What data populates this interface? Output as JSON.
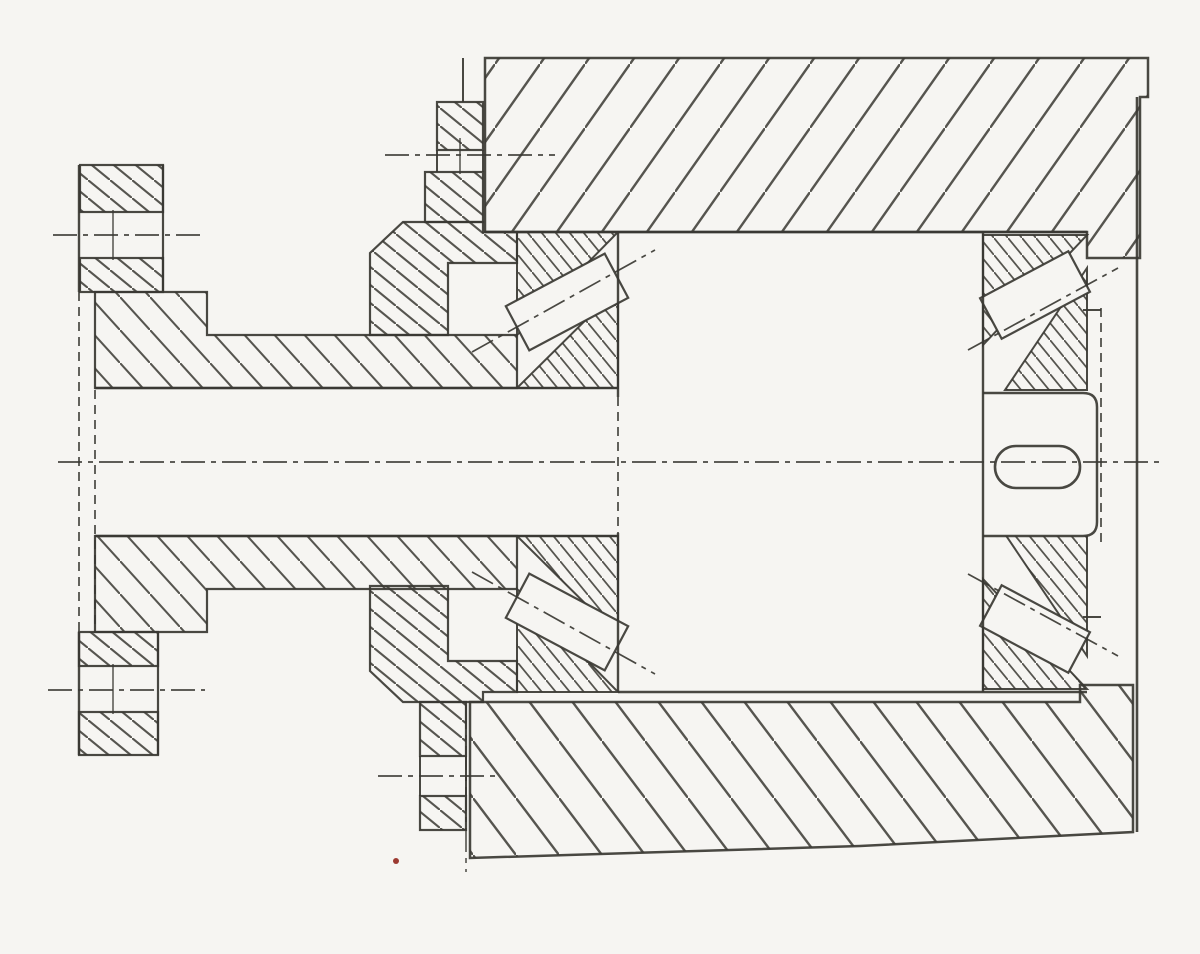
{
  "document": {
    "kind": "scanned-engineering-section-drawing",
    "colors": {
      "paper": "#f6f5f2",
      "ink": "#3a3833",
      "artifact_red": "#9c3a31"
    }
  },
  "canvas": {
    "width": 1200,
    "height": 954
  },
  "dashes": {
    "cl": "24 6 5 6",
    "hid": "9 6"
  },
  "hatches": [
    {
      "id": "hatch-housing-top",
      "dir": "/",
      "tw": 45,
      "th": 64,
      "sw": 2.4
    },
    {
      "id": "hatch-housing-bottom",
      "dir": "\\",
      "tw": 43,
      "th": 57,
      "sw": 2.4
    },
    {
      "id": "hatch-main",
      "dir": "\\",
      "tw": 22,
      "th": 18,
      "sw": 2.1
    },
    {
      "id": "hatch-sparse",
      "dir": "\\",
      "tw": 30,
      "th": 33,
      "sw": 2.1
    },
    {
      "id": "hatch-dense",
      "dir": "\\",
      "tw": 14,
      "th": 17,
      "sw": 1.8
    }
  ],
  "shapes": [
    {
      "name": "housing-upper-block",
      "type": "poly",
      "pts": "485,58 1148,58 1148,97 1140,97 1140,258 1087,258 1087,232 485,232",
      "fill": "hatch-housing-top",
      "sw": 2.5
    },
    {
      "name": "housing-lower-block",
      "type": "poly",
      "pts": "470,702 1080,702 1080,685 1133,685 1133,832 860,846 470,858",
      "fill": "hatch-housing-bottom",
      "sw": 2.5
    },
    {
      "name": "top-cap-lug",
      "type": "rect",
      "x": 437,
      "y": 102,
      "w": 46,
      "h": 48,
      "fill": "hatch-main",
      "sw": 2.2
    },
    {
      "name": "top-cap-neck",
      "type": "rect",
      "x": 425,
      "y": 172,
      "w": 58,
      "h": 50,
      "fill": "hatch-main",
      "sw": 2.2
    },
    {
      "name": "top-cap-body",
      "type": "poly",
      "pts": "370,253 403,222 483,222 483,232 517,232 517,263 448,263 448,335 370,335",
      "fill": "hatch-main",
      "sw": 2.2
    },
    {
      "name": "bottom-cap-body",
      "type": "poly",
      "pts": "370,671 403,702 483,702 483,692 517,692 517,661 448,661 448,586 370,586",
      "fill": "hatch-main",
      "sw": 2.2
    },
    {
      "name": "bottom-cap-neck",
      "type": "rect",
      "x": 420,
      "y": 702,
      "w": 46,
      "h": 54,
      "fill": "hatch-main",
      "sw": 2.2
    },
    {
      "name": "bottom-cap-lug",
      "type": "rect",
      "x": 420,
      "y": 796,
      "w": 46,
      "h": 34,
      "fill": "hatch-main",
      "sw": 2.2
    },
    {
      "name": "flange-top-outer",
      "type": "rect",
      "x": 80,
      "y": 165,
      "w": 83,
      "h": 47,
      "fill": "hatch-main",
      "sw": 2.2
    },
    {
      "name": "flange-top-inner",
      "type": "rect",
      "x": 80,
      "y": 258,
      "w": 83,
      "h": 34,
      "fill": "hatch-main",
      "sw": 2.2
    },
    {
      "name": "flange-bottom-inner",
      "type": "rect",
      "x": 79,
      "y": 632,
      "w": 79,
      "h": 34,
      "fill": "hatch-main",
      "sw": 2.2
    },
    {
      "name": "flange-bottom-outer",
      "type": "rect",
      "x": 79,
      "y": 712,
      "w": 79,
      "h": 43,
      "fill": "hatch-main",
      "sw": 2.2
    },
    {
      "name": "hub-sleeve-top",
      "type": "poly",
      "pts": "95,292 207,292 207,335 517,335 517,388 95,388",
      "fill": "hatch-sparse",
      "sw": 2.2
    },
    {
      "name": "hub-sleeve-bottom",
      "type": "poly",
      "pts": "95,536 517,536 517,589 207,589 207,632 95,632",
      "fill": "hatch-sparse",
      "sw": 2.2
    },
    {
      "name": "bearing-top-left-cup",
      "type": "poly",
      "pts": "517,232 618,232 517,335",
      "fill": "hatch-dense",
      "sw": 2
    },
    {
      "name": "bearing-top-left-cone",
      "type": "poly",
      "pts": "517,388 618,388 618,288",
      "fill": "hatch-dense",
      "sw": 2
    },
    {
      "name": "bearing-top-right-cup",
      "type": "poly",
      "pts": "983,235 1087,235 983,345",
      "fill": "hatch-dense",
      "sw": 2
    },
    {
      "name": "bearing-top-right-cone",
      "type": "poly",
      "pts": "1005,390 1087,390 1087,268",
      "fill": "hatch-dense",
      "sw": 2
    },
    {
      "name": "bearing-bottom-left-cone",
      "type": "poly",
      "pts": "517,536 618,536 618,636",
      "fill": "hatch-dense",
      "sw": 2
    },
    {
      "name": "bearing-bottom-left-cup",
      "type": "poly",
      "pts": "517,692 618,692 517,589",
      "fill": "hatch-dense",
      "sw": 2
    },
    {
      "name": "bearing-bottom-right-cone",
      "type": "poly",
      "pts": "1005,534 1087,534 1087,656",
      "fill": "hatch-dense",
      "sw": 2
    },
    {
      "name": "bearing-bottom-right-cup",
      "type": "poly",
      "pts": "983,689 1087,689 983,579",
      "fill": "hatch-dense",
      "sw": 2
    },
    {
      "name": "shaft-end-stub",
      "type": "path",
      "d": "M 983,393 L 1083,393 Q 1097,393 1097,407 L 1097,522 Q 1097,536 1083,536 L 983,536",
      "fill": "paper",
      "sw": 2.5
    },
    {
      "name": "bearing-roller-top-left",
      "type": "roller",
      "cx": 567,
      "cy": 302,
      "w": 112,
      "h": 50,
      "rot": -28,
      "sw": 2.2
    },
    {
      "name": "bearing-roller-top-right",
      "type": "roller",
      "cx": 1035,
      "cy": 295,
      "w": 100,
      "h": 46,
      "rot": -28,
      "sw": 2.2
    },
    {
      "name": "bearing-roller-bottom-left",
      "type": "roller",
      "cx": 567,
      "cy": 622,
      "w": 112,
      "h": 50,
      "rot": 28,
      "sw": 2.2
    },
    {
      "name": "bearing-roller-bottom-right",
      "type": "roller",
      "cx": 1035,
      "cy": 629,
      "w": 100,
      "h": 46,
      "rot": 28,
      "sw": 2.2
    },
    {
      "name": "key-slot",
      "type": "rect",
      "x": 995,
      "y": 446,
      "w": 85,
      "h": 42,
      "rx": 21,
      "fill": "paper",
      "sw": 2.6
    },
    {
      "name": "shaft-top-line",
      "type": "line",
      "x1": 95,
      "y1": 388,
      "x2": 618,
      "y2": 388,
      "sw": 2.6
    },
    {
      "name": "shaft-bottom-line",
      "type": "line",
      "x1": 95,
      "y1": 536,
      "x2": 618,
      "y2": 536,
      "sw": 2.6
    },
    {
      "name": "housing-bore-top-line",
      "type": "line",
      "x1": 485,
      "y1": 232,
      "x2": 1087,
      "y2": 232,
      "sw": 2.6
    },
    {
      "name": "midsection-bottom-line",
      "type": "line",
      "x1": 618,
      "y1": 692,
      "x2": 1087,
      "y2": 692,
      "sw": 2.4
    },
    {
      "name": "midsection-left-face-top",
      "type": "line",
      "x1": 618,
      "y1": 232,
      "x2": 618,
      "y2": 397,
      "sw": 2.4
    },
    {
      "name": "midsection-left-face-hidden",
      "type": "line",
      "x1": 618,
      "y1": 397,
      "x2": 618,
      "y2": 533,
      "sw": 1.7,
      "dash": "hid"
    },
    {
      "name": "midsection-left-face-bottom",
      "type": "line",
      "x1": 618,
      "y1": 533,
      "x2": 618,
      "y2": 692,
      "sw": 2.4
    },
    {
      "name": "midsection-right-face",
      "type": "line",
      "x1": 983,
      "y1": 232,
      "x2": 983,
      "y2": 692,
      "sw": 2.4
    },
    {
      "name": "flange-left-edge-top",
      "type": "line",
      "x1": 79,
      "y1": 165,
      "x2": 79,
      "y2": 292,
      "sw": 2.4
    },
    {
      "name": "flange-left-edge-hidden",
      "type": "line",
      "x1": 79,
      "y1": 292,
      "x2": 79,
      "y2": 632,
      "sw": 1.7,
      "dash": "hid"
    },
    {
      "name": "flange-left-edge-bottom",
      "type": "line",
      "x1": 79,
      "y1": 632,
      "x2": 79,
      "y2": 755,
      "sw": 2.4
    },
    {
      "name": "flange-bore-hidden-edge",
      "type": "line",
      "x1": 95,
      "y1": 390,
      "x2": 95,
      "y2": 630,
      "sw": 1.7,
      "dash": "hid"
    },
    {
      "name": "flange-top-right-face",
      "type": "line",
      "x1": 163,
      "y1": 165,
      "x2": 163,
      "y2": 292,
      "sw": 2.2
    },
    {
      "name": "flange-bottom-right-face",
      "type": "line",
      "x1": 158,
      "y1": 632,
      "x2": 158,
      "y2": 755,
      "sw": 2.2
    },
    {
      "name": "top-cap-bolt-hole-left-edge",
      "type": "line",
      "x1": 437,
      "y1": 150,
      "x2": 437,
      "y2": 172,
      "sw": 2
    },
    {
      "name": "top-cap-bolt-hole-right-edge",
      "type": "line",
      "x1": 483,
      "y1": 150,
      "x2": 483,
      "y2": 172,
      "sw": 2
    },
    {
      "name": "bottom-cap-bolt-hole-left-edge",
      "type": "line",
      "x1": 420,
      "y1": 756,
      "x2": 420,
      "y2": 796,
      "sw": 2
    },
    {
      "name": "bottom-cap-bolt-hole-right-edge",
      "type": "line",
      "x1": 466,
      "y1": 756,
      "x2": 466,
      "y2": 796,
      "sw": 2
    },
    {
      "name": "top-boss-edge",
      "type": "line",
      "x1": 463,
      "y1": 58,
      "x2": 463,
      "y2": 102,
      "sw": 2
    },
    {
      "name": "housing-right-outer-edge",
      "type": "line",
      "x1": 1137,
      "y1": 97,
      "x2": 1137,
      "y2": 832,
      "sw": 2.6
    },
    {
      "name": "end-plate-hidden-edge",
      "type": "line",
      "x1": 1101,
      "y1": 308,
      "x2": 1101,
      "y2": 545,
      "sw": 1.7,
      "dash": "hid"
    },
    {
      "name": "end-plate-step-top",
      "type": "line",
      "x1": 1083,
      "y1": 310,
      "x2": 1101,
      "y2": 310,
      "sw": 2
    },
    {
      "name": "end-plate-step-bottom",
      "type": "line",
      "x1": 1083,
      "y1": 617,
      "x2": 1101,
      "y2": 617,
      "sw": 2
    },
    {
      "name": "main-centerline",
      "type": "line",
      "x1": 58,
      "y1": 462,
      "x2": 1165,
      "y2": 462,
      "sw": 1.7,
      "dash": "cl"
    },
    {
      "name": "flange-bolt-centerline-top",
      "type": "line",
      "x1": 53,
      "y1": 235,
      "x2": 205,
      "y2": 235,
      "sw": 1.7,
      "dash": "cl"
    },
    {
      "name": "flange-bolt-tick-top",
      "type": "line",
      "x1": 113,
      "y1": 210,
      "x2": 113,
      "y2": 260,
      "sw": 1.4
    },
    {
      "name": "flange-bolt-centerline-bottom",
      "type": "line",
      "x1": 48,
      "y1": 690,
      "x2": 205,
      "y2": 690,
      "sw": 1.7,
      "dash": "cl"
    },
    {
      "name": "flange-bolt-tick-bottom",
      "type": "line",
      "x1": 113,
      "y1": 664,
      "x2": 113,
      "y2": 714,
      "sw": 1.4
    },
    {
      "name": "cap-bolt-centerline-top",
      "type": "line",
      "x1": 385,
      "y1": 155,
      "x2": 555,
      "y2": 155,
      "sw": 1.7,
      "dash": "cl"
    },
    {
      "name": "cap-bolt-tick-top",
      "type": "line",
      "x1": 460,
      "y1": 138,
      "x2": 460,
      "y2": 174,
      "sw": 1.4
    },
    {
      "name": "cap-bolt-centerline-bottom",
      "type": "line",
      "x1": 378,
      "y1": 776,
      "x2": 497,
      "y2": 776,
      "sw": 1.7,
      "dash": "cl"
    },
    {
      "name": "cap-axis-vertical",
      "type": "line",
      "x1": 466,
      "y1": 705,
      "x2": 466,
      "y2": 872,
      "sw": 1.5,
      "dash": "cl"
    },
    {
      "name": "bearing-axis-top-left",
      "type": "line",
      "x1": 472,
      "y1": 352,
      "x2": 655,
      "y2": 250,
      "sw": 1.7,
      "dash": "cl"
    },
    {
      "name": "bearing-axis-top-right",
      "type": "line",
      "x1": 968,
      "y1": 350,
      "x2": 1118,
      "y2": 268,
      "sw": 1.7,
      "dash": "cl"
    },
    {
      "name": "bearing-axis-bottom-left",
      "type": "line",
      "x1": 472,
      "y1": 572,
      "x2": 655,
      "y2": 674,
      "sw": 1.7,
      "dash": "cl"
    },
    {
      "name": "bearing-axis-bottom-right",
      "type": "line",
      "x1": 968,
      "y1": 574,
      "x2": 1118,
      "y2": 656,
      "sw": 1.7,
      "dash": "cl"
    },
    {
      "name": "scan-artifact-dot",
      "type": "circle",
      "cx": 396,
      "cy": 861,
      "r": 3,
      "fill": "#9c3a31",
      "sw": 0
    }
  ]
}
